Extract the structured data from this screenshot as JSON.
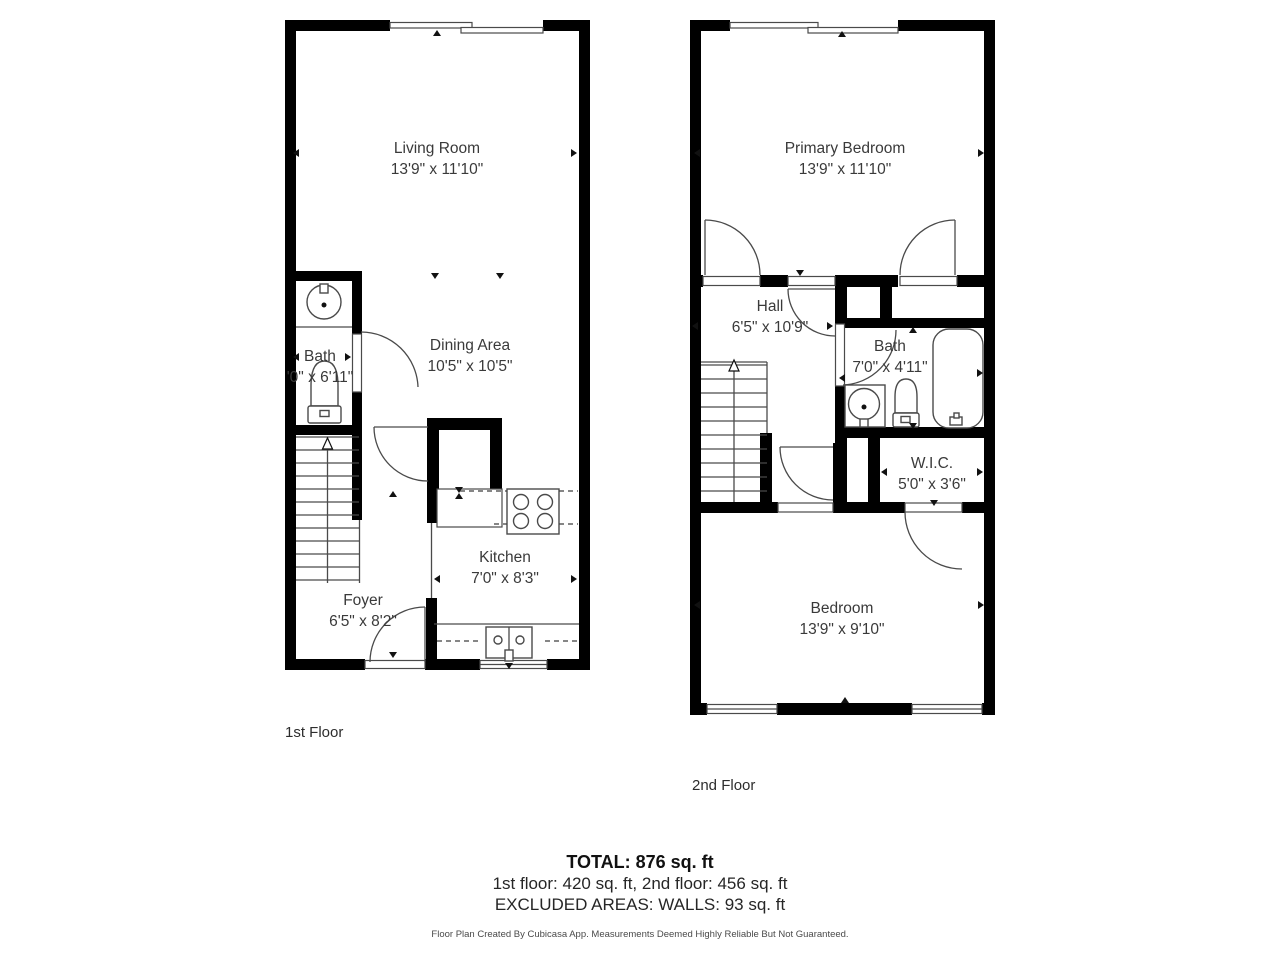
{
  "floors": [
    {
      "label": "1st Floor",
      "rooms": [
        {
          "name": "Living Room",
          "dims": "13'9\" x 11'10\""
        },
        {
          "name": "Bath",
          "dims": "'0\" x 6'11\""
        },
        {
          "name": "Dining Area",
          "dims": "10'5\" x 10'5\""
        },
        {
          "name": "Kitchen",
          "dims": "7'0\" x 8'3\""
        },
        {
          "name": "Foyer",
          "dims": "6'5\" x 8'2\""
        }
      ]
    },
    {
      "label": "2nd Floor",
      "rooms": [
        {
          "name": "Primary Bedroom",
          "dims": "13'9\" x 11'10\""
        },
        {
          "name": "Hall",
          "dims": "6'5\" x 10'9\""
        },
        {
          "name": "Bath",
          "dims": "7'0\" x 4'11\""
        },
        {
          "name": "W.I.C.",
          "dims": "5'0\" x 3'6\""
        },
        {
          "name": "Bedroom",
          "dims": "13'9\" x 9'10\""
        }
      ]
    }
  ],
  "summary": {
    "total": "TOTAL: 876 sq. ft",
    "floor_breakdown": "1st floor: 420 sq. ft, 2nd floor: 456 sq. ft",
    "excluded": "EXCLUDED AREAS: WALLS: 93 sq. ft",
    "disclaimer": "Floor Plan Created By Cubicasa App. Measurements Deemed Highly Reliable But Not Guaranteed."
  },
  "colors": {
    "wall": "#000000",
    "line": "#4a4a4a",
    "text": "#3a3a3a"
  }
}
